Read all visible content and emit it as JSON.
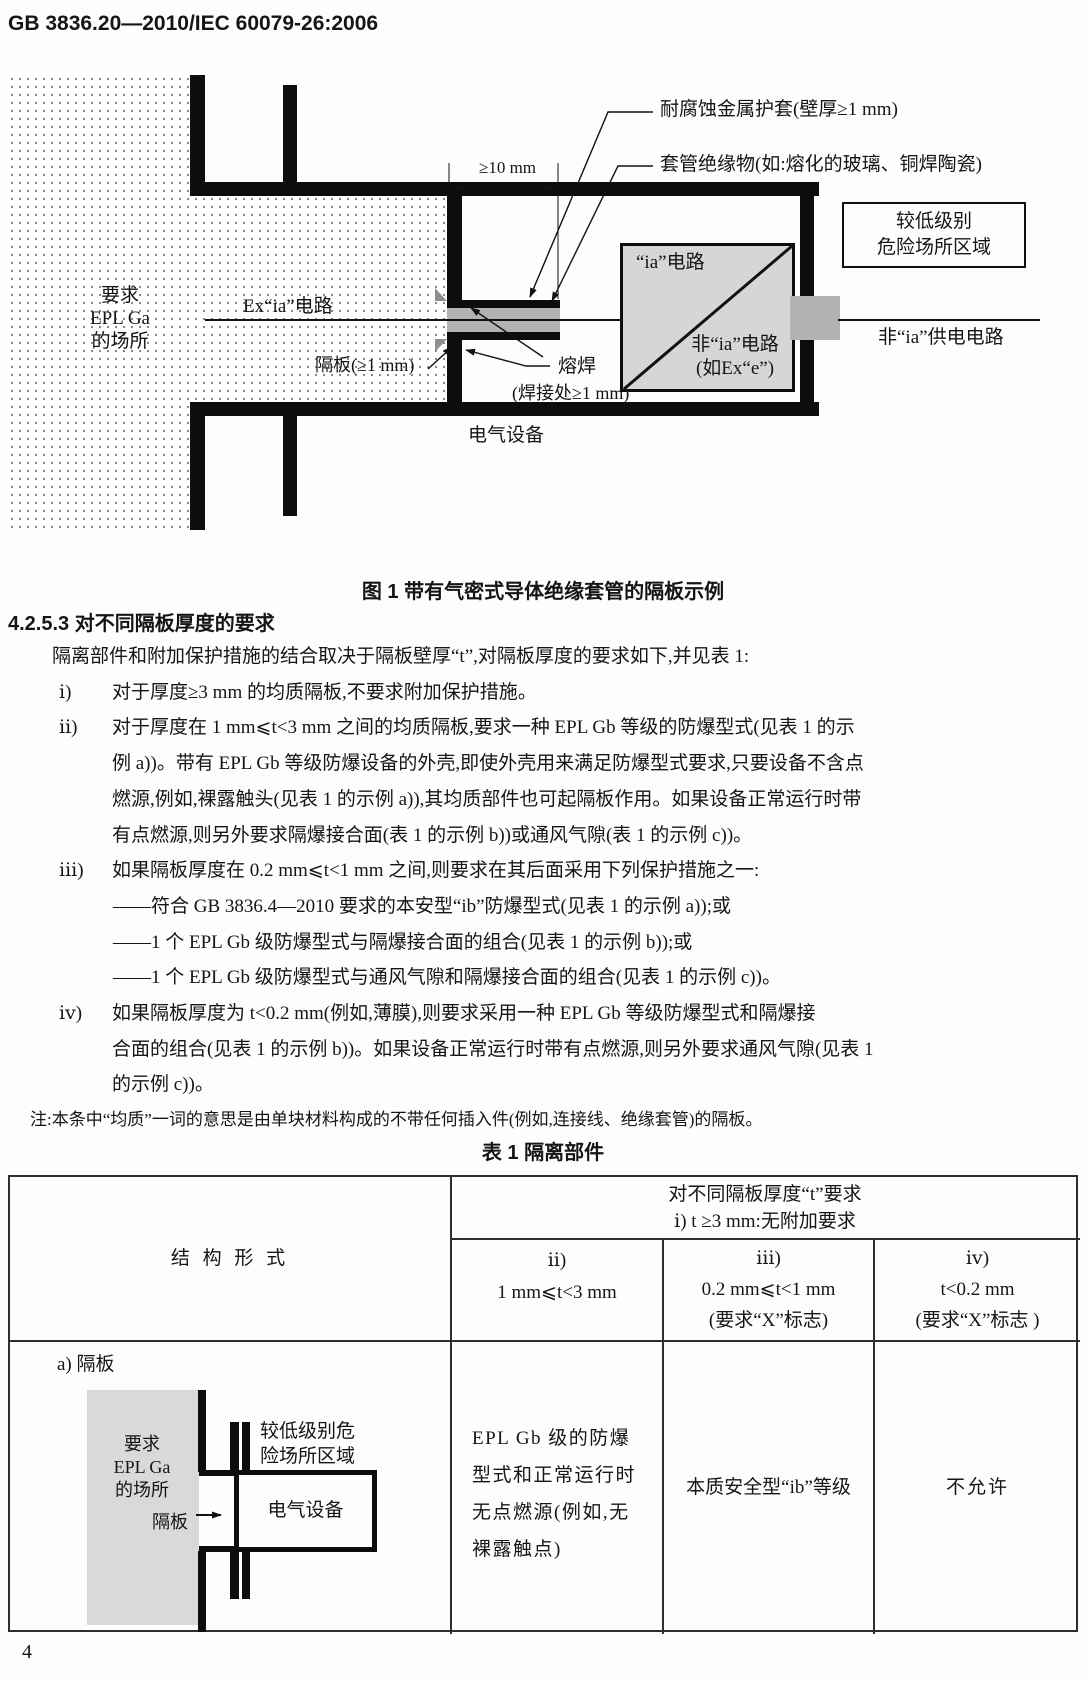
{
  "header": {
    "standard_number": "GB 3836.20—2010/IEC 60079-26:2006",
    "page_number": "4"
  },
  "figure1": {
    "caption": "图 1  带有气密式导体绝缘套管的隔板示例",
    "labels": {
      "sheath": "耐腐蚀金属护套(壁厚≥1 mm)",
      "insulation": "套管绝缘物(如:熔化的玻璃、铜焊陶瓷)",
      "dimension": "≥10 mm",
      "area_left_l1": "要求",
      "area_left_l2": "EPL Ga",
      "area_left_l3": "的场所",
      "ex_ia_circuit": "Ex“ia”电路",
      "ia_circuit": "“ia”电路",
      "non_ia_circuit_l1": "非“ia”电路",
      "non_ia_circuit_l2": "(如Ex“e”)",
      "lower_area_l1": "较低级别",
      "lower_area_l2": "危险场所区域",
      "non_ia_supply": "非“ia”供电电路",
      "partition": "隔板(≥1 mm)",
      "weld_l1": "熔焊",
      "weld_l2": "(焊接处≥1 mm)",
      "equipment": "电气设备"
    }
  },
  "section": {
    "heading": "4.2.5.3  对不同隔板厚度的要求"
  },
  "paragraphs": [
    {
      "lines": [
        "隔离部件和附加保护措施的结合取决于隔板壁厚“t”,对隔板厚度的要求如下,并见表 1:"
      ]
    },
    {
      "marker": "ⅰ)",
      "lines": [
        "对于厚度≥3 mm 的均质隔板,不要求附加保护措施。"
      ]
    },
    {
      "marker": "ⅱ)",
      "lines": [
        "对于厚度在 1 mm⩽t<3 mm 之间的均质隔板,要求一种 EPL Gb 等级的防爆型式(见表 1 的示",
        "例 a))。带有 EPL Gb 等级防爆设备的外壳,即使外壳用来满足防爆型式要求,只要设备不含点",
        "燃源,例如,裸露触头(见表 1 的示例 a)),其均质部件也可起隔板作用。如果设备正常运行时带",
        "有点燃源,则另外要求隔爆接合面(表 1 的示例 b))或通风气隙(表 1 的示例 c))。"
      ]
    },
    {
      "marker": "ⅲ)",
      "lines": [
        "如果隔板厚度在 0.2 mm⩽t<1 mm 之间,则要求在其后面采用下列保护措施之一:",
        "——符合 GB 3836.4—2010 要求的本安型“ib”防爆型式(见表 1 的示例 a));或",
        "——1 个 EPL Gb 级防爆型式与隔爆接合面的组合(见表 1 的示例 b));或",
        "——1 个 EPL Gb 级防爆型式与通风气隙和隔爆接合面的组合(见表 1 的示例 c))。"
      ]
    },
    {
      "marker": "ⅳ)",
      "lines": [
        "如果隔板厚度为 t<0.2 mm(例如,薄膜),则要求采用一种 EPL Gb 等级防爆型式和隔爆接",
        "合面的组合(见表 1 的示例 b))。如果设备正常运行时带有点燃源,则另外要求通风气隙(见表 1",
        "的示例 c))。"
      ]
    }
  ],
  "note": "注:本条中“均质”一词的意思是由单块材料构成的不带任何插入件(例如,连接线、绝缘套管)的隔板。",
  "table1": {
    "title": "表 1  隔离部件",
    "header": {
      "col0": "结 构 形 式",
      "top": "对不同隔板厚度“t”要求",
      "top_sub": "ⅰ) t ≥3 mm:无附加要求",
      "cols": [
        {
          "marker": "ⅱ)",
          "range": "1 mm⩽t<3 mm",
          "note": ""
        },
        {
          "marker": "ⅲ)",
          "range": "0.2 mm⩽t<1 mm",
          "note": "(要求“X”标志)"
        },
        {
          "marker": "ⅳ)",
          "range": "t<0.2 mm",
          "note": "(要求“X”标志 )"
        }
      ]
    },
    "row_a": {
      "label": "a) 隔板",
      "diagram": {
        "area_l1": "要求",
        "area_l2": "EPL Ga",
        "area_l3": "的场所",
        "lower_l1": "较低级别危",
        "lower_l2": "险场所区域",
        "equipment": "电气设备",
        "partition": "隔板"
      },
      "cells": [
        {
          "lines": [
            "EPL Gb 级的防爆",
            "型式和正常运行时",
            "无点燃源(例如,无",
            "裸露触点)"
          ]
        },
        {
          "lines": [
            "本质安全型“ib”等级"
          ]
        },
        {
          "lines": [
            "不允许"
          ]
        }
      ]
    }
  }
}
